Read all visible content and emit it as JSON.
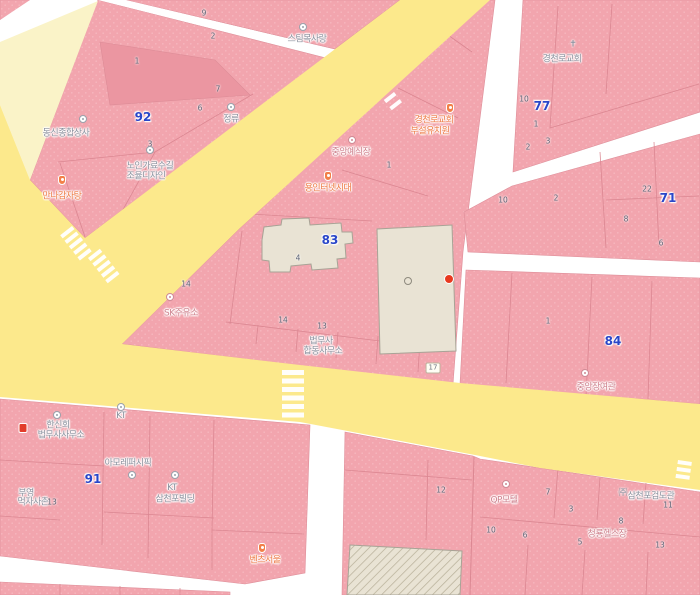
{
  "map": {
    "colors": {
      "block_pink": "#f2a5ae",
      "block_pink_dark": "#eb96a1",
      "road_yellow": "#fce98c",
      "road_pale_yellow": "#faf3c8",
      "road_white": "#ffffff",
      "building_beige": "#e9e3d4",
      "parcel_line": "#d9848f",
      "block_number_blue": "#2946c9",
      "poi_gray": "#8b919e",
      "poi_orange": "#ee7b45",
      "poi_pink": "#cf828e",
      "red_dot": "#e8391f"
    },
    "block_numbers": [
      {
        "text": "92"
      },
      {
        "text": "77"
      },
      {
        "text": "71"
      },
      {
        "text": "83"
      },
      {
        "text": "84"
      },
      {
        "text": "91"
      }
    ],
    "poi_labels": [
      {
        "text": "스팀목사랑"
      },
      {
        "text": "정류"
      },
      {
        "text": "동신종합상사"
      },
      {
        "text": "노인가료수길"
      },
      {
        "text": "조율디자인"
      },
      {
        "text": "만나감자탕"
      },
      {
        "text": "경천로교회"
      },
      {
        "text": "경천로교회"
      },
      {
        "text": "부설유치원"
      },
      {
        "text": "중앙예식장"
      },
      {
        "text": "용인터넷시대"
      },
      {
        "text": "SK주유소"
      },
      {
        "text": "법무사"
      },
      {
        "text": "합동사무소"
      },
      {
        "text": "중앙장여관"
      },
      {
        "text": "한신회"
      },
      {
        "text": "법무사사무소"
      },
      {
        "text": "KT"
      },
      {
        "text": "아모레퍼시픽"
      },
      {
        "text": "KT"
      },
      {
        "text": "삼천포빌딩"
      },
      {
        "text": "부영"
      },
      {
        "text": "먹자사촌"
      },
      {
        "text": "벤츠서울"
      },
      {
        "text": "QP모텔"
      },
      {
        "text": "삼천포검도관"
      },
      {
        "text": "청룡헬스장"
      }
    ],
    "parcel_numbers": [
      {
        "text": "9"
      },
      {
        "text": "2"
      },
      {
        "text": "1"
      },
      {
        "text": "7"
      },
      {
        "text": "6"
      },
      {
        "text": "3"
      },
      {
        "text": "10"
      },
      {
        "text": "1"
      },
      {
        "text": "3"
      },
      {
        "text": "2"
      },
      {
        "text": "10"
      },
      {
        "text": "2"
      },
      {
        "text": "22"
      },
      {
        "text": "8"
      },
      {
        "text": "6"
      },
      {
        "text": "1"
      },
      {
        "text": "1"
      },
      {
        "text": "14"
      },
      {
        "text": "4"
      },
      {
        "text": "14"
      },
      {
        "text": "13"
      },
      {
        "text": "13"
      },
      {
        "text": "12"
      },
      {
        "text": "7"
      },
      {
        "text": "3"
      },
      {
        "text": "10"
      },
      {
        "text": "6"
      },
      {
        "text": "5"
      },
      {
        "text": "8"
      },
      {
        "text": "11"
      },
      {
        "text": "13"
      }
    ],
    "route_shield": {
      "text": "17"
    },
    "icons": {
      "church_glyph": "✝",
      "company_glyph": "㈜"
    }
  }
}
